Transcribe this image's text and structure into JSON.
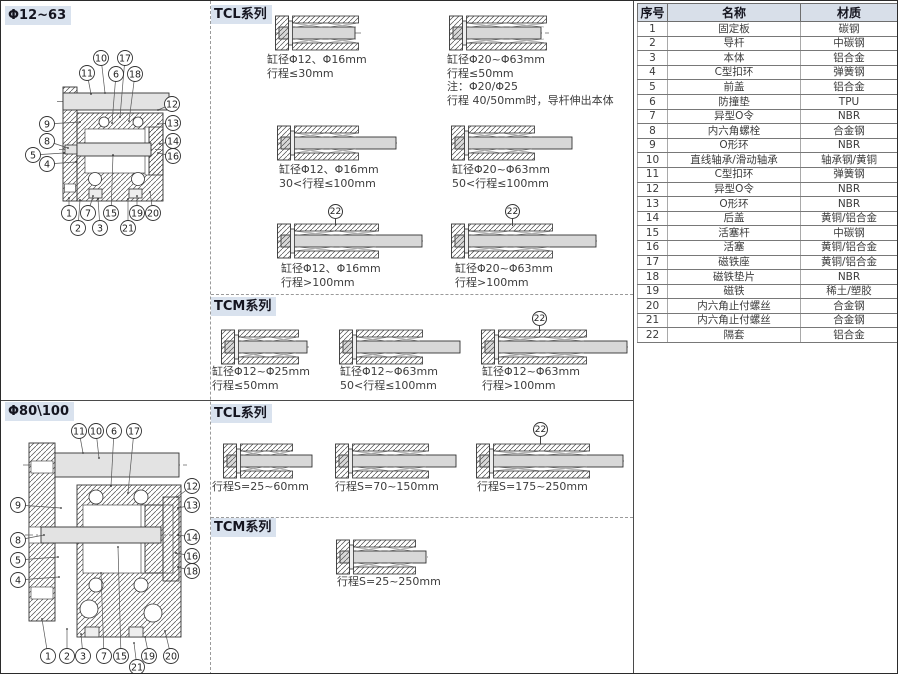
{
  "sections": {
    "top_left": {
      "title": "Φ12~63"
    },
    "tcl_top": {
      "title": "TCL系列"
    },
    "tcm_top": {
      "title": "TCM系列"
    },
    "bottom_left": {
      "title": "Φ80\\100"
    },
    "tcl_bottom": {
      "title": "TCL系列"
    },
    "tcm_bottom": {
      "title": "TCM系列"
    }
  },
  "drawings": {
    "d1": {
      "callouts": [
        "10",
        "17",
        "11",
        "6",
        "18",
        "12",
        "9",
        "13",
        "8",
        "14",
        "5",
        "16",
        "4",
        "1",
        "7",
        "15",
        "19",
        "20",
        "2",
        "3",
        "21"
      ]
    },
    "d2": {
      "callouts": [
        "11",
        "10",
        "6",
        "17",
        "12",
        "13",
        "9",
        "8",
        "14",
        "5",
        "16",
        "4",
        "18",
        "1",
        "2",
        "3",
        "7",
        "15",
        "19",
        "20",
        "21"
      ]
    }
  },
  "figures": {
    "tcl1": {
      "lines": [
        "缸径Φ12、Φ16mm",
        "行程≤30mm"
      ]
    },
    "tcl2": {
      "lines": [
        "缸径Φ20~Φ63mm",
        "行程≤50mm",
        "注：Φ20/Φ25",
        "行程 40/50mm时，导杆伸出本体"
      ]
    },
    "tcl3": {
      "lines": [
        "缸径Φ12、Φ16mm",
        "30<行程≤100mm"
      ]
    },
    "tcl4": {
      "lines": [
        "缸径Φ20~Φ63mm",
        "50<行程≤100mm"
      ]
    },
    "tcl5": {
      "callout": "22",
      "lines": [
        "缸径Φ12、Φ16mm",
        "行程>100mm"
      ]
    },
    "tcl6": {
      "callout": "22",
      "lines": [
        "缸径Φ20~Φ63mm",
        "行程>100mm"
      ]
    },
    "tcm1": {
      "lines": [
        "缸径Φ12~Φ25mm",
        "行程≤50mm"
      ]
    },
    "tcm2": {
      "lines": [
        "缸径Φ12~Φ63mm",
        "50<行程≤100mm"
      ]
    },
    "tcm3": {
      "callout": "22",
      "lines": [
        "缸径Φ12~Φ63mm",
        "行程>100mm"
      ]
    },
    "btcl1": {
      "lines": [
        "行程S=25~60mm"
      ]
    },
    "btcl2": {
      "lines": [
        "行程S=70~150mm"
      ]
    },
    "btcl3": {
      "callout": "22",
      "lines": [
        "行程S=175~250mm"
      ]
    },
    "btcm1": {
      "lines": [
        "行程S=25~250mm"
      ]
    }
  },
  "parts_table": {
    "headers": [
      "序号",
      "名称",
      "材质"
    ],
    "rows": [
      [
        "1",
        "固定板",
        "碳钢"
      ],
      [
        "2",
        "导杆",
        "中碳钢"
      ],
      [
        "3",
        "本体",
        "铝合金"
      ],
      [
        "4",
        "C型扣环",
        "弹簧钢"
      ],
      [
        "5",
        "前盖",
        "铝合金"
      ],
      [
        "6",
        "防撞垫",
        "TPU"
      ],
      [
        "7",
        "异型O令",
        "NBR"
      ],
      [
        "8",
        "内六角螺栓",
        "合金钢"
      ],
      [
        "9",
        "O形环",
        "NBR"
      ],
      [
        "10",
        "直线轴承/滑动轴承",
        "轴承钢/黄铜"
      ],
      [
        "11",
        "C型扣环",
        "弹簧钢"
      ],
      [
        "12",
        "异型O令",
        "NBR"
      ],
      [
        "13",
        "O形环",
        "NBR"
      ],
      [
        "14",
        "后盖",
        "黄铜/铝合金"
      ],
      [
        "15",
        "活塞杆",
        "中碳钢"
      ],
      [
        "16",
        "活塞",
        "黄铜/铝合金"
      ],
      [
        "17",
        "磁铁座",
        "黄铜/铝合金"
      ],
      [
        "18",
        "磁铁垫片",
        "NBR"
      ],
      [
        "19",
        "磁铁",
        "稀土/塑胶"
      ],
      [
        "20",
        "内六角止付螺丝",
        "合金钢"
      ],
      [
        "21",
        "内六角止付螺丝",
        "合金钢"
      ],
      [
        "22",
        "隔套",
        "铝合金"
      ]
    ]
  },
  "colors": {
    "header_bg": "#d9e2ee",
    "table_header_bg": "#d8dfe9",
    "rod_fill": "#d8d8d8"
  }
}
